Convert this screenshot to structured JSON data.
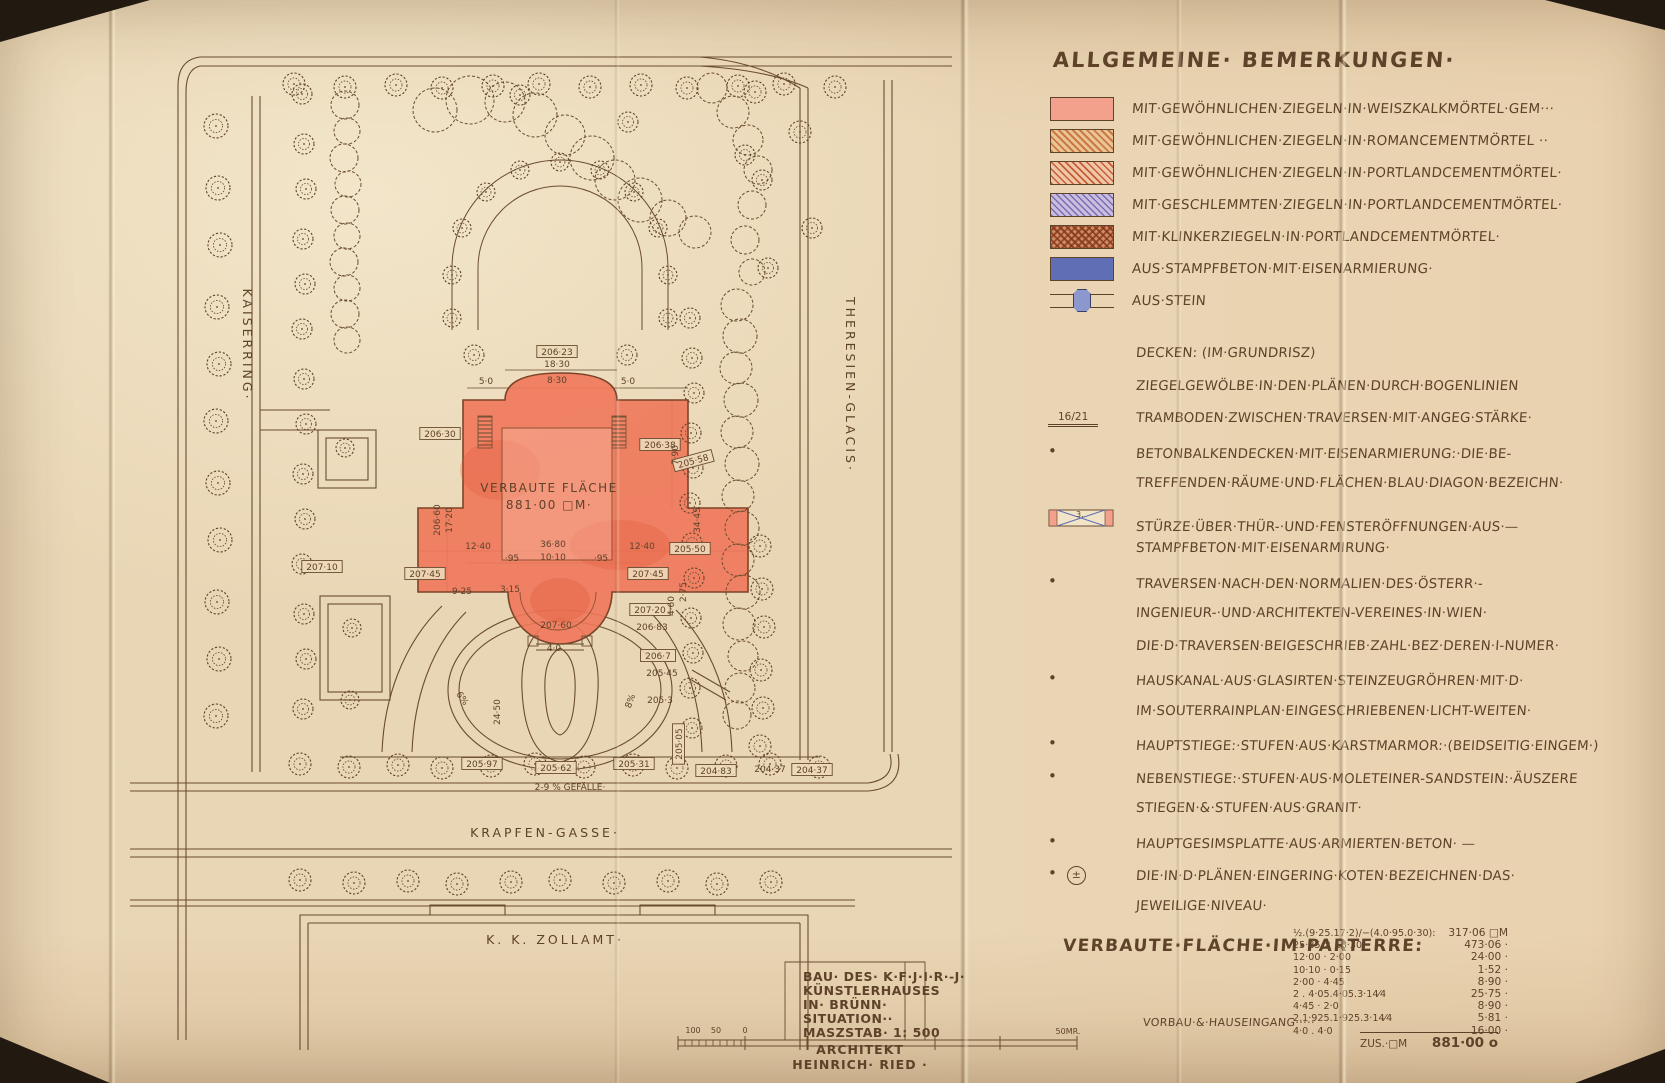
{
  "page": {
    "bg": "#e9d6b5",
    "ink": "#5e422a",
    "building_red": "#f0775a"
  },
  "header": {
    "title": "ALLGEMEINE· BEMERKUNGEN·"
  },
  "legend": {
    "items": [
      {
        "swatch": "solid-pink",
        "label": "MIT·GEWÖHNLICHEN·ZIEGELN·IN·WEISZKALKMÖRTEL·GEM···"
      },
      {
        "swatch": "hatch-orange",
        "label": "MIT·GEWÖHNLICHEN·ZIEGELN·IN·ROMANCEMENTMÖRTEL ··"
      },
      {
        "swatch": "hatch-red",
        "label": "MIT·GEWÖHNLICHEN·ZIEGELN·IN·PORTLANDCEMENTMÖRTEL·"
      },
      {
        "swatch": "hatch-violet",
        "label": "MIT·GESCHLEMMTEN·ZIEGELN·IN·PORTLANDCEMENTMÖRTEL·"
      },
      {
        "swatch": "cross-klinker",
        "label": "MIT·KLINKERZIEGELN·IN·PORTLANDCEMENTMÖRTEL·"
      },
      {
        "swatch": "solid-blue",
        "label": "AUS·STAMPFBETON·MIT·EISENARMIERUNG·"
      },
      {
        "swatch": "stein",
        "label": "AUS·STEIN"
      }
    ]
  },
  "notes": {
    "sturz_number": "3.",
    "plusminus": "±",
    "rows": [
      {
        "m": "",
        "mt": "",
        "t": "DECKEN: (IM·GRUNDRISZ)"
      },
      {
        "m": "",
        "mt": "",
        "t": "ZIEGELGEWÖLBE·IN·DEN·PLÄNEN·DURCH·BOGENLINIEN"
      },
      {
        "m": "frac",
        "mt": "16/21",
        "t": "TRAMBODEN·ZWISCHEN·TRAVERSEN·MIT·ANGEG·STÄRKE·"
      },
      {
        "m": "dot",
        "mt": "•",
        "t": "BETONBALKENDECKEN·MIT·EISENARMIERUNG:·DIE·BE-"
      },
      {
        "m": "",
        "mt": "",
        "t": "TREFFENDEN·RÄUME·UND·FLÄCHEN·BLAU·DIAGON·BEZEICHN·"
      },
      {
        "m": "sturz",
        "mt": "",
        "t": "STÜRZE·ÜBER·THÜR-·UND·FENSTERÖFFNUNGEN·AUS·—"
      },
      {
        "m": "",
        "mt": "",
        "t": "STAMPFBETON·MIT·EISENARMIRUNG·"
      },
      {
        "m": "dot",
        "mt": "•",
        "t": "TRAVERSEN·NACH·DEN·NORMALIEN·DES·ÖSTERR·-"
      },
      {
        "m": "",
        "mt": "",
        "t": "INGENIEUR-·UND·ARCHITEKTEN-VEREINES·IN·WIEN·"
      },
      {
        "m": "",
        "mt": "",
        "t": "DIE·D·TRAVERSEN·BEIGESCHRIEB·ZAHL·BEZ·DEREN·I-NUMER·"
      },
      {
        "m": "dot",
        "mt": "•",
        "t": "HAUSKANAL·AUS·GLASIRTEN·STEINZEUGRÖHREN·MIT·D·"
      },
      {
        "m": "",
        "mt": "",
        "t": "IM·SOUTERRAINPLAN·EINGESCHRIEBENEN·LICHT-WEITEN·"
      },
      {
        "m": "dot",
        "mt": "•",
        "t": "HAUPTSTIEGE:·STUFEN·AUS·KARSTMARMOR:·(BEIDSEITIG·EINGEM·)"
      },
      {
        "m": "dot",
        "mt": "•",
        "t": "NEBENSTIEGE:·STUFEN·AUS·MOLETEINER-SANDSTEIN:·ÄUSZERE"
      },
      {
        "m": "",
        "mt": "",
        "t": "STIEGEN·&·STUFEN·AUS·GRANIT·"
      },
      {
        "m": "dot",
        "mt": "•",
        "t": "HAUPTGESIMSPLATTE·AUS·ARMIERTEN·BETON·   —"
      },
      {
        "m": "dotpm",
        "mt": "•",
        "t": "DIE·IN·D·PLÄNEN·EINGERING·KOTEN·BEZEICHNEN·DAS·"
      },
      {
        "m": "",
        "mt": "",
        "t": "JEWEILIGE·NIVEAU·"
      }
    ]
  },
  "area_table": {
    "heading": "VERBAUTE·FLÄCHE·IM·PARTERRE:",
    "rows": [
      {
        "expr": "½.(9·25.17·2)/−(4.0·95.0·30):",
        "value": "317·06 □M"
      },
      {
        "expr": "25·85 × 18·30",
        "value": "473·06 ·"
      },
      {
        "expr": "12·00 · 2·00",
        "value": "24·00 ·"
      },
      {
        "expr": "10·10 · 0·15",
        "value": "1·52 ·"
      },
      {
        "expr": "2·00 · 4·45",
        "value": "8·90 ·"
      },
      {
        "expr": "2 . 4·05.4·05.3·14⁄4",
        "value": "25·75 ·"
      },
      {
        "expr": "4·45 · 2·0",
        "value": "8·90 ·"
      },
      {
        "expr": "2.1·925.1·925.3·14⁄4",
        "value": "5·81 ·"
      },
      {
        "expr": "4·0 . 4·0",
        "value": "16·00 ·"
      }
    ],
    "vorbau_label": "VORBAU·&·HAUSEINGANG·····",
    "total_label": "ZUS.·□M",
    "total_value": "881·00 o"
  },
  "plan": {
    "street_left": "KAISERRING·",
    "street_right": "THERESIEN-GLACIS·",
    "street_bottom": "KRAPFEN-GASSE·",
    "zollamt": "K. K. ZOLLAMT·",
    "building_label_1": "VERBAUTE FLÄCHE",
    "building_label_2": "881·00 □M·",
    "labels": [
      {
        "t": "206·23",
        "x": 557,
        "y": 355,
        "b": 1
      },
      {
        "t": "206·30",
        "x": 440,
        "y": 437,
        "b": 1
      },
      {
        "t": "206·38",
        "x": 660,
        "y": 448,
        "b": 1
      },
      {
        "t": "205·58",
        "x": 694,
        "y": 464,
        "b": 1,
        "r": -15
      },
      {
        "t": "207·45",
        "x": 425,
        "y": 577,
        "b": 1
      },
      {
        "t": "207·45",
        "x": 648,
        "y": 577,
        "b": 1
      },
      {
        "t": "205·50",
        "x": 690,
        "y": 552,
        "b": 1
      },
      {
        "t": "207·10",
        "x": 322,
        "y": 570,
        "b": 1
      },
      {
        "t": "207·20",
        "x": 650,
        "y": 613,
        "b": 1
      },
      {
        "t": "206·7",
        "x": 658,
        "y": 659,
        "b": 1
      },
      {
        "t": "205·97",
        "x": 482,
        "y": 767,
        "b": 1
      },
      {
        "t": "205·62",
        "x": 556,
        "y": 771,
        "b": 1
      },
      {
        "t": "205·31",
        "x": 634,
        "y": 767,
        "b": 1
      },
      {
        "t": "204·83",
        "x": 716,
        "y": 774,
        "b": 1
      },
      {
        "t": "204·37",
        "x": 812,
        "y": 773,
        "b": 1
      },
      {
        "t": "205·05",
        "x": 682,
        "y": 744,
        "b": 1,
        "r": -90
      },
      {
        "t": "18·30",
        "x": 557,
        "y": 367
      },
      {
        "t": "5·0",
        "x": 486,
        "y": 384
      },
      {
        "t": "8·30",
        "x": 557,
        "y": 383
      },
      {
        "t": "5·0",
        "x": 628,
        "y": 384
      },
      {
        "t": "7·90",
        "x": 678,
        "y": 455,
        "r": -90
      },
      {
        "t": "34·45",
        "x": 700,
        "y": 520,
        "r": -90
      },
      {
        "t": "206·60",
        "x": 440,
        "y": 520,
        "r": -90
      },
      {
        "t": "17·20",
        "x": 452,
        "y": 520,
        "r": -90
      },
      {
        "t": "36·80",
        "x": 553,
        "y": 547
      },
      {
        "t": "10·10",
        "x": 553,
        "y": 560
      },
      {
        "t": "12·40",
        "x": 478,
        "y": 549
      },
      {
        "t": "12·40",
        "x": 642,
        "y": 549
      },
      {
        "t": "·95",
        "x": 512,
        "y": 561
      },
      {
        "t": "·95",
        "x": 601,
        "y": 561
      },
      {
        "t": "9·25",
        "x": 462,
        "y": 594
      },
      {
        "t": "3·15",
        "x": 510,
        "y": 592
      },
      {
        "t": "207·60",
        "x": 556,
        "y": 628
      },
      {
        "t": "4·0",
        "x": 554,
        "y": 651
      },
      {
        "t": "206·83",
        "x": 652,
        "y": 630
      },
      {
        "t": "205·45",
        "x": 662,
        "y": 676
      },
      {
        "t": "205·3",
        "x": 660,
        "y": 703
      },
      {
        "t": "24·50",
        "x": 500,
        "y": 712,
        "r": -90
      },
      {
        "t": "6%",
        "x": 460,
        "y": 700,
        "r": 55
      },
      {
        "t": "8%",
        "x": 633,
        "y": 702,
        "r": -70
      },
      {
        "t": "2-9 % GEFÄLLE·",
        "x": 570,
        "y": 790
      },
      {
        "t": "204·37",
        "x": 770,
        "y": 772
      },
      {
        "t": "4·60",
        "x": 674,
        "y": 606,
        "r": -90
      },
      {
        "t": "2·75",
        "x": 686,
        "y": 592,
        "r": -90
      }
    ]
  },
  "titleblock": {
    "lines": [
      "BAU· DES· K·F·J·I·R·-J·",
      "KÜNSTLERHAUSES",
      "IN· BRÜNN·",
      "SITUATION··",
      "MASZSTAB·  1: 500"
    ],
    "architect_1": "ARCHITEKT",
    "architect_2": "HEINRICH· RIED ·"
  },
  "scalebar": {
    "ticks": [
      "100",
      "50",
      "0"
    ],
    "right": "50MR."
  }
}
